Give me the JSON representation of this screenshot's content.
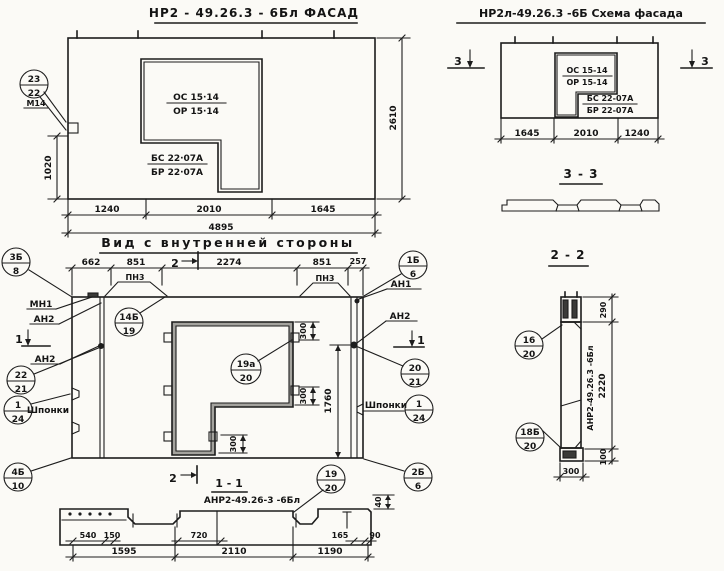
{
  "drawing": {
    "facade": {
      "title": "НР2 - 49.26.3 - 6Бл ФАСАД",
      "callout": {
        "top": "23",
        "bottom": "22",
        "note": "М14"
      },
      "marks": {
        "os": "ОС 15·14",
        "or": "ОР 15·14",
        "bs": "БС 22·07А",
        "br": "БР 22·07А"
      },
      "dims": {
        "left": "1020",
        "right": "2610",
        "bottom": [
          "1240",
          "2010",
          "1645"
        ],
        "total": "4895"
      }
    },
    "schema": {
      "title": "НР2л-49.26.3 -6Б  Схема фасада",
      "marks": {
        "os": "ОС 15-14",
        "or": "ОР 15-14",
        "bs": "БС 22-07А",
        "br": "БР 22-07А"
      },
      "dims": {
        "bottom": [
          "1645",
          "2010",
          "1240"
        ]
      },
      "section_marker": "3",
      "section_view_title": "3 - 3"
    },
    "inner": {
      "title": "Вид с внутренней стороны",
      "dims": {
        "top": [
          "662",
          "851",
          "2274",
          "851",
          "257"
        ],
        "d300": "300",
        "d1760": "1760"
      },
      "pn3": "ПН3",
      "labels": {
        "mn1": "МН1",
        "an1": "АН1",
        "an2": "АН2",
        "shponki": "Шпонки"
      },
      "markers": {
        "s1": "1",
        "s2": "2"
      },
      "callouts": {
        "c3b8": {
          "top": "3Б",
          "bottom": "8"
        },
        "c14b19": {
          "top": "14Б",
          "bottom": "19"
        },
        "c22_21": {
          "top": "22",
          "bottom": "21"
        },
        "c1_24": {
          "top": "1",
          "bottom": "24"
        },
        "c4b10": {
          "top": "4Б",
          "bottom": "10"
        },
        "c19a20": {
          "top": "19а",
          "bottom": "20"
        },
        "c1b6": {
          "top": "1Б",
          "bottom": "6"
        },
        "c20_21": {
          "top": "20",
          "bottom": "21"
        },
        "c2b6": {
          "top": "2Б",
          "bottom": "6"
        }
      }
    },
    "section11": {
      "title": "1 - 1",
      "label": "АНР2-49.26-3 -6Бл",
      "callout": {
        "top": "19",
        "bottom": "20"
      },
      "dims": {
        "upper": [
          "540",
          "150",
          "720",
          "165",
          "90"
        ],
        "lower": [
          "1595",
          "2110",
          "1190"
        ],
        "d40": "40"
      }
    },
    "section22": {
      "title": "2 - 2",
      "label": "АНР2-49.26.3 -6Бл",
      "callouts": {
        "c16_20": {
          "top": "16",
          "bottom": "20"
        },
        "c18b20": {
          "top": "18Б",
          "bottom": "20"
        }
      },
      "dims": {
        "d290": "290",
        "d2220": "2220",
        "d100": "100",
        "d300": "300"
      }
    }
  }
}
